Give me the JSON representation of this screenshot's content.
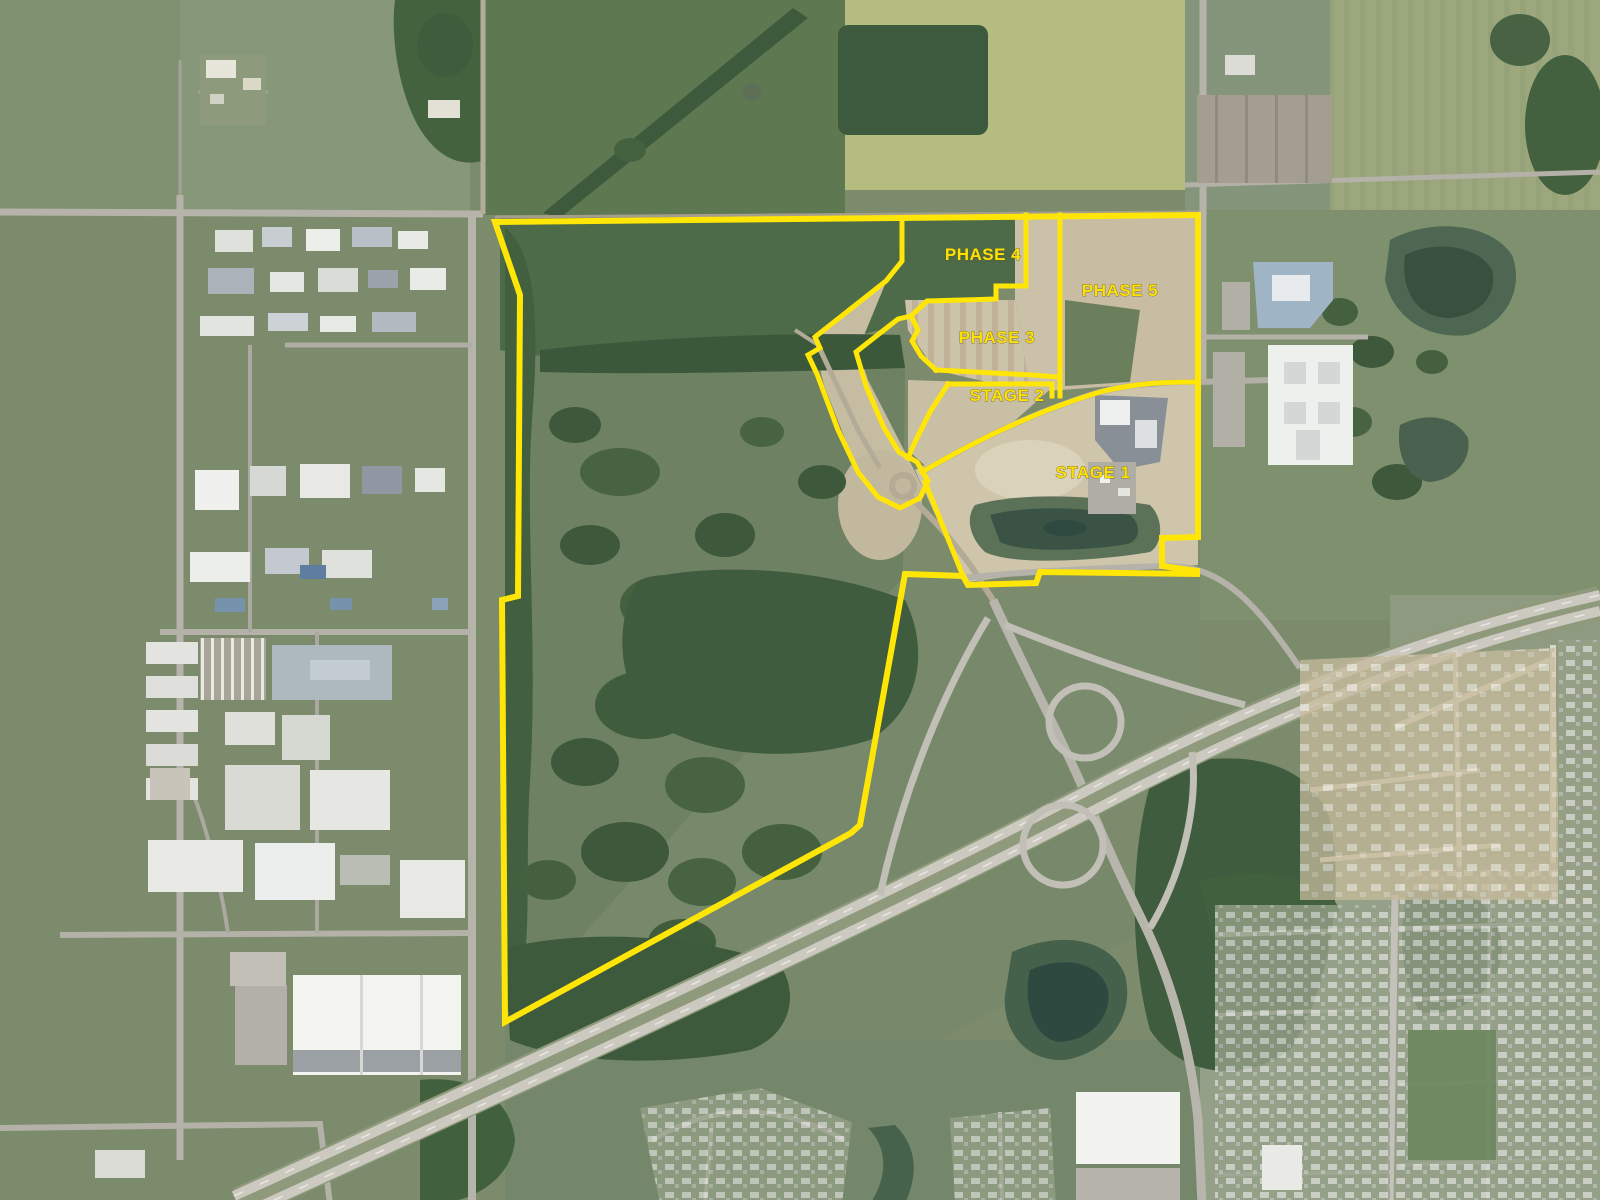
{
  "map": {
    "kind": "aerial-satellite-site-plan",
    "overlay": {
      "line_color": "#ffe606",
      "label_color": "#ffe106",
      "labels": [
        {
          "id": "phase-4",
          "text": "PHASE 4"
        },
        {
          "id": "phase-5",
          "text": "PHASE 5"
        },
        {
          "id": "phase-3",
          "text": "PHASE 3"
        },
        {
          "id": "stage-2",
          "text": "STAGE 2"
        },
        {
          "id": "stage-1",
          "text": "STAGE 1"
        }
      ]
    }
  }
}
